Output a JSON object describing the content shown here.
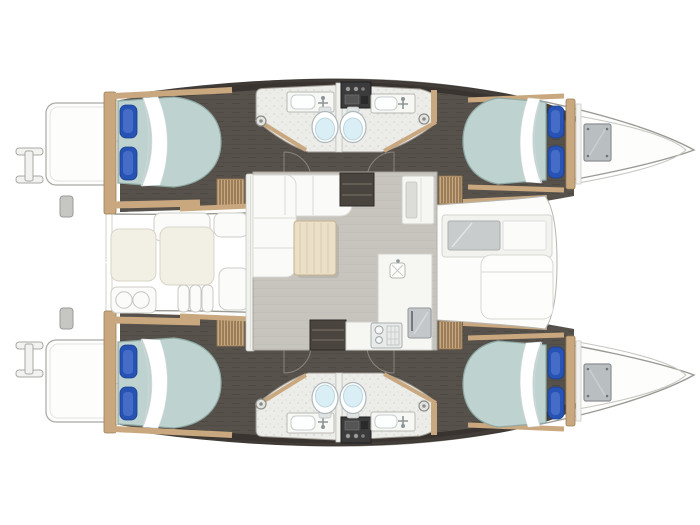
{
  "vessel": {
    "type": "catamaran",
    "view": "top-down deck plan",
    "orientation": "bows right, transoms left",
    "symmetry": "port and starboard hulls mirrored"
  },
  "inventory": {
    "cabins": {
      "count": 4,
      "berths": 4,
      "pillows_per_berth": 2
    },
    "heads": {
      "count": 4,
      "fixtures": [
        "toilet",
        "vanity-sink",
        "shower-drain"
      ]
    },
    "salon": {
      "features": [
        "l-shaped-sofa",
        "wood-table",
        "galley-counter",
        "stove",
        "island-sink",
        "refrigerator",
        "dark-storage-cabinets",
        "sliding-door"
      ]
    },
    "cockpit": {
      "features": [
        "bench-seats",
        "helm-seat-two-cushions",
        "moulded-steps"
      ]
    },
    "foredeck": {
      "features": [
        "sunpad",
        "forward-window-band",
        "bow-hatches"
      ]
    },
    "stern": {
      "features": [
        "swim-platforms",
        "boarding-ladders",
        "deck-cleats",
        "companionway-stairs"
      ]
    }
  },
  "colors": {
    "background": "#ffffff",
    "hull_outline": "#9a9a95",
    "deck_white": "#fdfdfc",
    "interior_floor": "#57514b",
    "interior_band": "#38332e",
    "wood_trim": "#c9a87f",
    "mattress": "#bed3cf",
    "pillow": "#2753b4",
    "pillow_highlight": "#6388d9",
    "bath_floor": "#ecece9",
    "toilet_water": "#d9eef5",
    "console_dark": "#3b3b3b",
    "salon_floor": "#c7c4be",
    "sofa": "#fafaf8",
    "table_wood": "#ebdfc8",
    "counter": "#f6f6f3",
    "cabinet_dark": "#49443e",
    "appliance": "#c3c7c9",
    "hatch": "#b9bec1",
    "bench_cream": "#f2efe5",
    "bench_white": "#fbfbf9"
  }
}
